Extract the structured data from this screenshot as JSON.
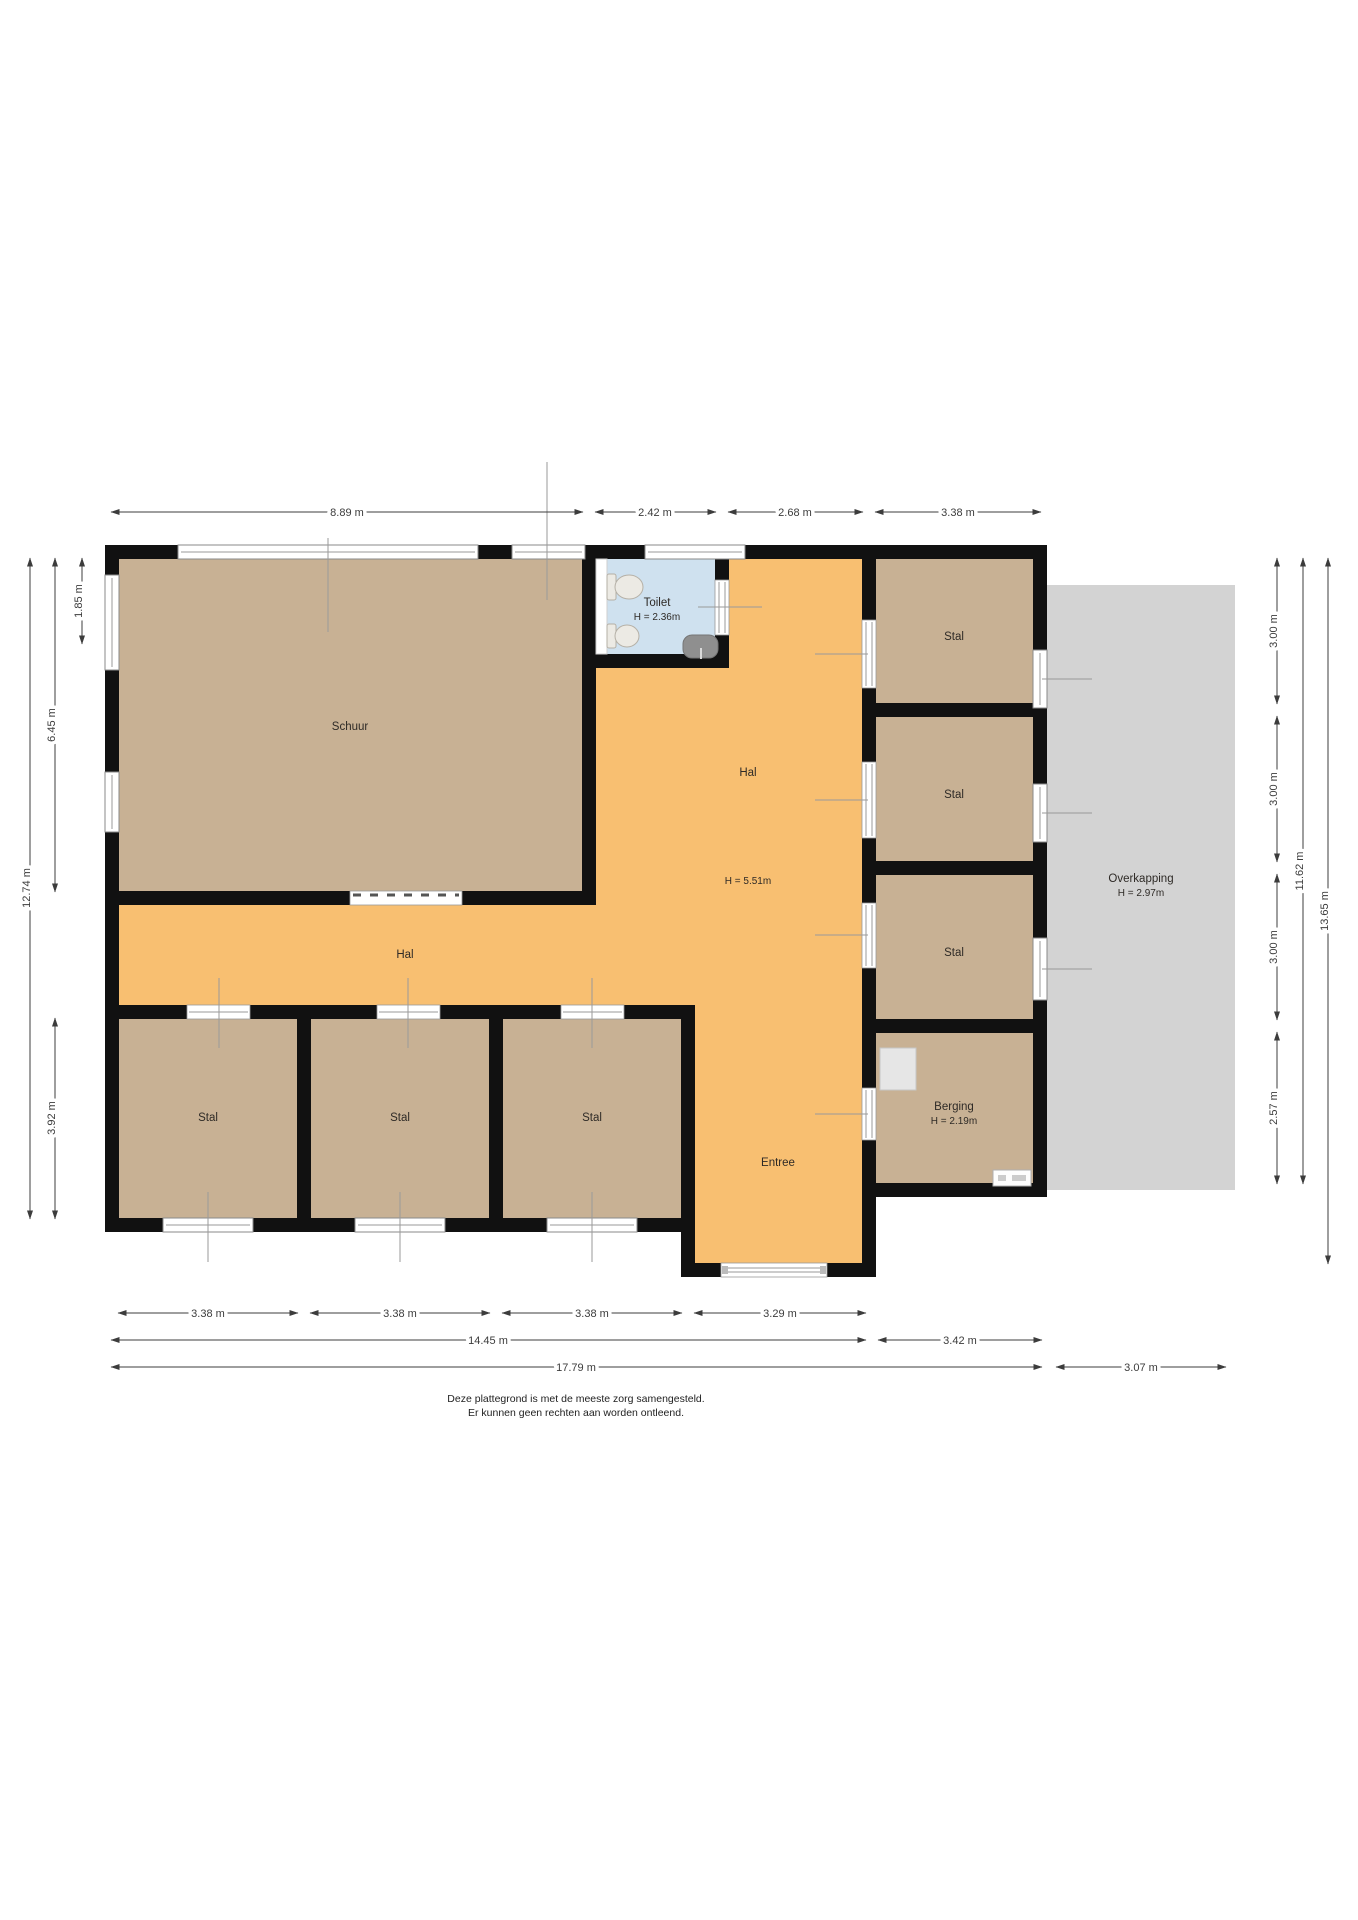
{
  "footer": {
    "line1": "Deze plattegrond is met de meeste zorg samengesteld.",
    "line2": "Er kunnen geen rechten aan worden ontleend."
  },
  "rooms": {
    "schuur": {
      "label": "Schuur"
    },
    "toilet": {
      "label": "Toilet",
      "height": "H = 2.36m"
    },
    "hal": {
      "label": "Hal",
      "height": "H = 5.51m"
    },
    "hal_west": {
      "label": "Hal"
    },
    "stal_right_1": {
      "label": "Stal"
    },
    "stal_right_2": {
      "label": "Stal"
    },
    "stal_right_3": {
      "label": "Stal"
    },
    "berging": {
      "label": "Berging",
      "height": "H = 2.19m"
    },
    "stal_bottom_1": {
      "label": "Stal"
    },
    "stal_bottom_2": {
      "label": "Stal"
    },
    "stal_bottom_3": {
      "label": "Stal"
    },
    "entree": {
      "label": "Entree"
    },
    "overkapping": {
      "label": "Overkapping",
      "height": "H = 2.97m"
    }
  },
  "dimensions": {
    "top": [
      {
        "label": "8.89 m"
      },
      {
        "label": "2.42 m"
      },
      {
        "label": "2.68 m"
      },
      {
        "label": "3.38 m"
      }
    ],
    "bottom_row1": [
      {
        "label": "3.38 m"
      },
      {
        "label": "3.38 m"
      },
      {
        "label": "3.38 m"
      },
      {
        "label": "3.29 m"
      }
    ],
    "bottom_row2": [
      {
        "label": "14.45 m"
      },
      {
        "label": "3.42 m"
      }
    ],
    "bottom_row3": [
      {
        "label": "17.79 m"
      },
      {
        "label": "3.07 m"
      }
    ],
    "left": [
      {
        "label": "1.85 m"
      },
      {
        "label": "6.45 m"
      },
      {
        "label": "12.74 m"
      },
      {
        "label": "3.92 m"
      }
    ],
    "right": [
      {
        "label": "3.00 m"
      },
      {
        "label": "3.00 m"
      },
      {
        "label": "3.00 m"
      },
      {
        "label": "2.57 m"
      },
      {
        "label": "11.62 m"
      },
      {
        "label": "13.65 m"
      }
    ]
  },
  "colors": {
    "wall": "#111111",
    "room_tan": "#c8b194",
    "hall_orange": "#f8bf71",
    "toilet_blue": "#cfe1ef",
    "overkapping_gray": "#d3d3d3",
    "dimension": "#3c3c3c",
    "window_frame": "#8a8a8a"
  }
}
